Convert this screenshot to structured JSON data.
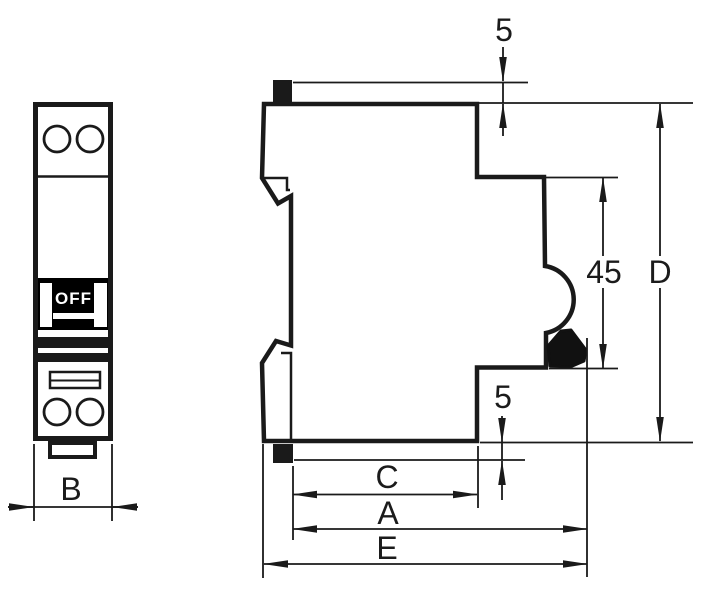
{
  "front_view": {
    "toggle_label": "OFF",
    "width_label": "B"
  },
  "side_view": {
    "top_clearance_label": "5",
    "handle_zone_label": "45",
    "overall_height_label": "D",
    "bottom_clearance_label": "5",
    "body_depth_label": "C",
    "depth_to_handle_label": "A",
    "overall_depth_label": "E"
  },
  "colors": {
    "line": "#1a1a1a",
    "background": "#ffffff",
    "toggle_fill": "#000000",
    "toggle_text": "#ffffff"
  }
}
